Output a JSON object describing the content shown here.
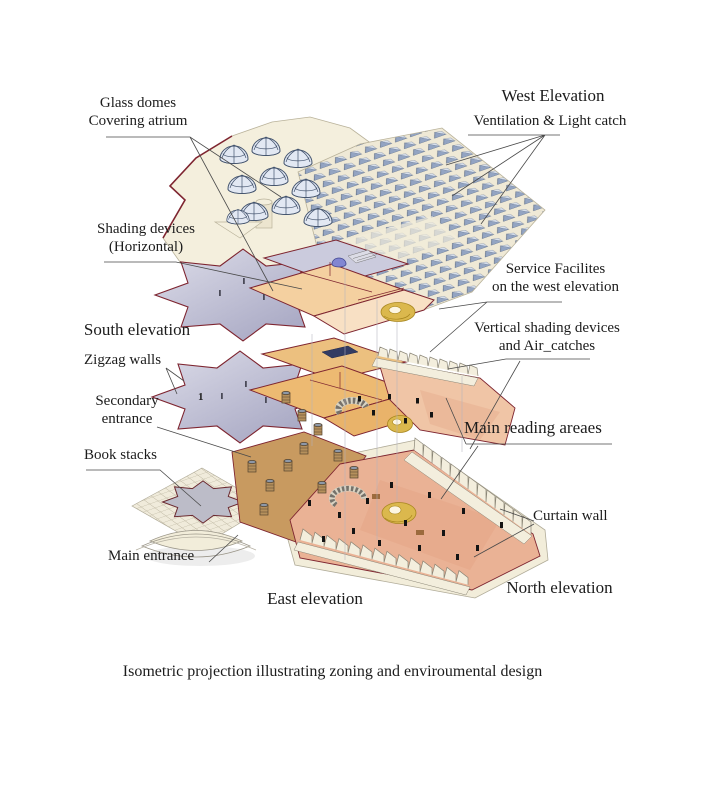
{
  "figure": {
    "caption": "Isometric projection illustrating zoning and enviroumental design"
  },
  "labels": {
    "glass_domes_line1": "Glass domes",
    "glass_domes_line2": "Covering atrium",
    "west_elevation": "West Elevation",
    "ventilation_light_catch": "Ventilation & Light catch",
    "shading_devices_line1": "Shading devices",
    "shading_devices_line2": "(Horizontal)",
    "south_elevation": "South elevation",
    "service_facilities_line1": "Service Facilites",
    "service_facilities_line2": "on the west elevation",
    "vertical_shading_line1": "Vertical shading devices",
    "vertical_shading_line2": "and Air_catches",
    "zigzag_walls": "Zigzag walls",
    "secondary_entrance_line1": "Secondary",
    "secondary_entrance_line2": "entrance",
    "main_reading_areas": "Main reading areaes",
    "book_stacks": "Book stacks",
    "curtain_wall": "Curtain wall",
    "main_entrance": "Main entrance",
    "east_elevation": "East elevation",
    "north_elevation": "North elevation"
  },
  "drawing": {
    "floor_number_label": "1",
    "colors": {
      "maroon_outline": "#7e2530",
      "cream_surface": "#f2ecd9",
      "lavender_floor": "#c5c5d9",
      "peach_floor": "#f4d0a0",
      "orange_floor": "#edba72",
      "salmon_floor": "#eab295",
      "tan_floor": "#c89a60",
      "gold_ramp": "#dbb84d",
      "skylight_blue": "#93a4c2",
      "dome_wireframe": "#44546e"
    }
  }
}
